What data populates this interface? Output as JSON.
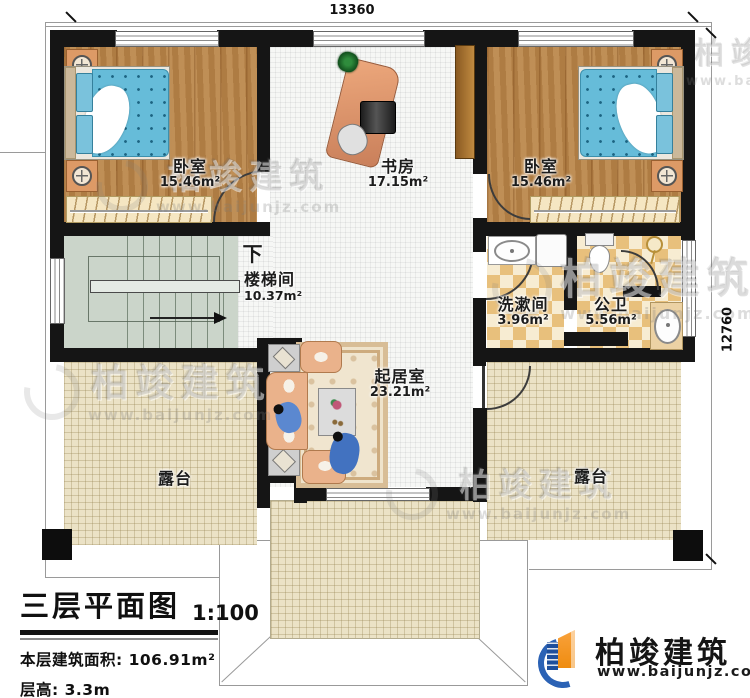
{
  "dimensions": {
    "top": "13360",
    "right": "12760"
  },
  "plan": {
    "down_label": "下",
    "rooms": [
      {
        "id": "bedroom-left",
        "name": "卧室",
        "area": "15.46m²"
      },
      {
        "id": "study",
        "name": "书房",
        "area": "17.15m²"
      },
      {
        "id": "bedroom-right",
        "name": "卧室",
        "area": "15.46m²"
      },
      {
        "id": "stairwell",
        "name": "楼梯间",
        "area": "10.37m²"
      },
      {
        "id": "washroom",
        "name": "洗漱间",
        "area": "3.96m²"
      },
      {
        "id": "toilet",
        "name": "公卫",
        "area": "5.56m²"
      },
      {
        "id": "living-room",
        "name": "起居室",
        "area": "23.21m²"
      },
      {
        "id": "terrace-left",
        "name": "露台"
      },
      {
        "id": "terrace-right",
        "name": "露台"
      }
    ]
  },
  "title_block": {
    "title": "三层平面图",
    "scale": "1:100",
    "area_label": "本层建筑面积:",
    "area_value": "106.91m²",
    "floor_height_label": "层高:",
    "floor_height_value": "3.3m"
  },
  "brand": {
    "name": "柏竣建筑",
    "url": "www.baijunjz.com"
  },
  "watermark": {
    "name": "柏竣建筑",
    "url": "www.baijunjz.com"
  },
  "colors": {
    "wall": "#151515",
    "wood_floor": "#b5824a",
    "tile_dark": "#e8c07c",
    "tile_light": "#f7ecd2",
    "terrace": "#ebe2c6",
    "stair": "#cbd5ca",
    "bed_blue": "#66bcd9",
    "sofa_peach": "#eab28b",
    "brand_blue": "#2b62b5",
    "brand_orange": "#f7941d"
  }
}
